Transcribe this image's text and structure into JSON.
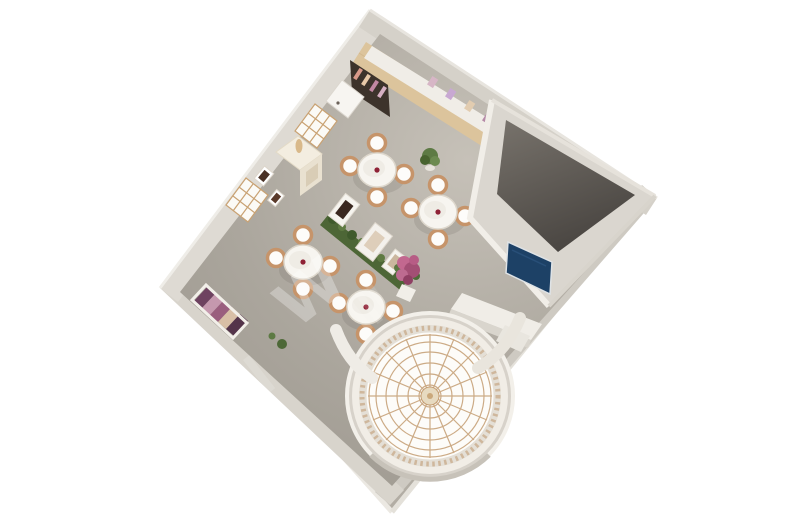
{
  "scene": {
    "description": "Aerial 3D rendering of a boutique showroom interior with a domed rotunda skylight",
    "watermark_text": "W",
    "background_color": "#ffffff"
  },
  "palette": {
    "wall_light": "#dedad3",
    "wall_medium": "#d5d1c9",
    "floor_main": "#aba69d",
    "floor_light": "#c6c1b8",
    "wood_strip": "#dcc49c",
    "counter_white": "#f0ede7",
    "alcove_dark": "#3d332b",
    "closed_room_floor": "#5f5b55",
    "tv_screen": "#1d4166",
    "table_top": "#f7f5f0",
    "chair_tan": "#c6946a",
    "table_accent": "#8f2236",
    "hedge_green": "#4d6636",
    "flower_pink": "#bd6b90",
    "dome_rib": "#c49d72",
    "rotunda_wall": "#f1ede6",
    "display_purple": "#6e4260"
  },
  "inventory": {
    "table_sets": 4,
    "chairs_per_table": 4,
    "wall_windows": 2,
    "divider_display_frames": 3,
    "areas": [
      "main showroom",
      "enclosed corner room",
      "domed rotunda entry"
    ]
  }
}
